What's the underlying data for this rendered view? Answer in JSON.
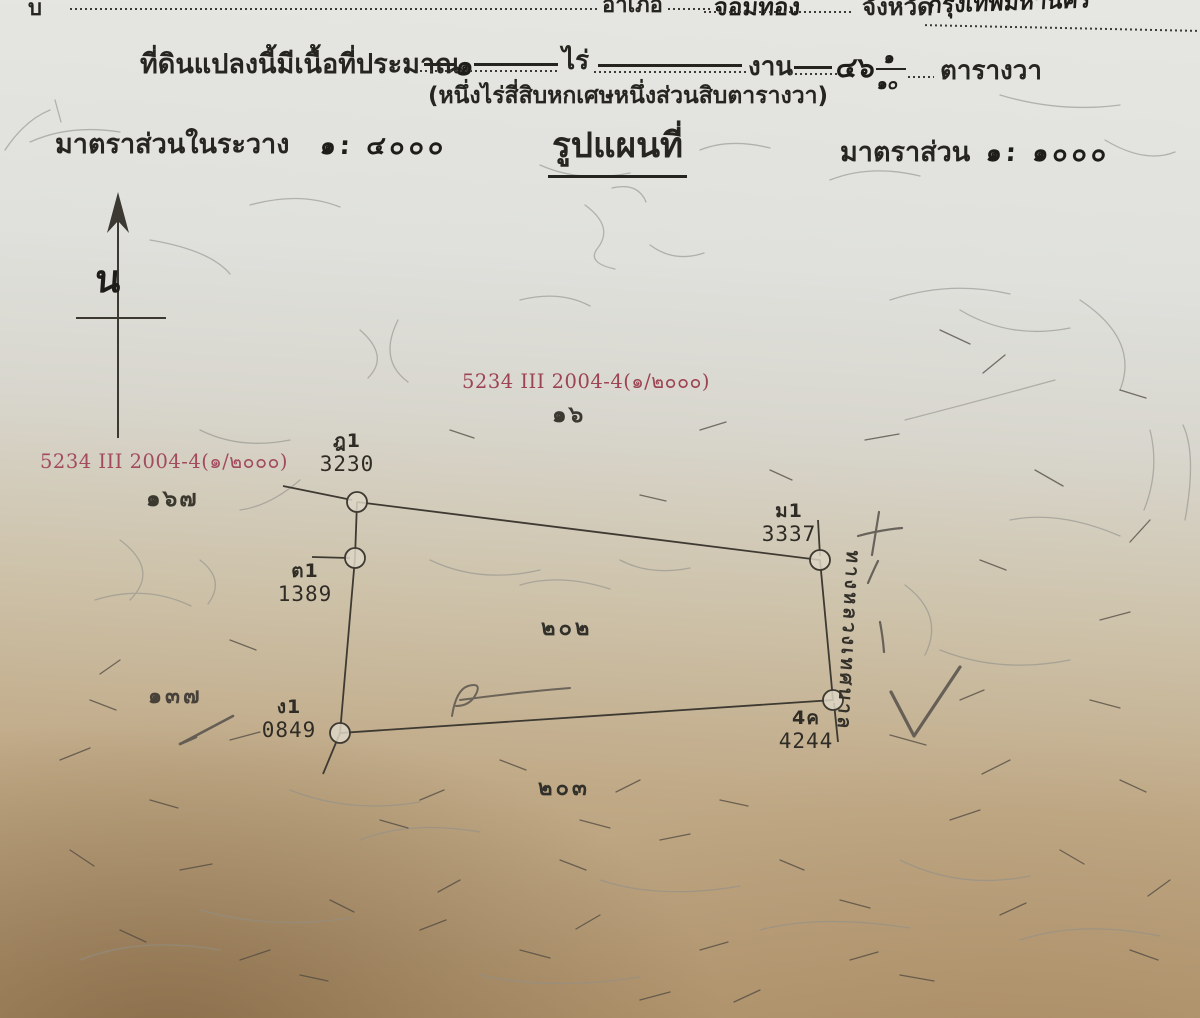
{
  "top_line": {
    "left_fragment": "บ",
    "district_label": "อำเภอ",
    "district_value": "จอมทอง",
    "province_label": "จังหวัด",
    "province_value": "กรุงเทพมหานคร"
  },
  "area_line": {
    "prefix": "ที่ดินแปลงนี้มีเนื้อที่ประมาณ",
    "rai_value": "๑",
    "rai_label": "ไร่",
    "ngan_label": "งาน",
    "wa_whole": "๔๖",
    "wa_frac_num": "๑",
    "wa_frac_den": "๑๐",
    "wa_label": "ตารางวา",
    "spelled_out": "(หนึ่งไร่สี่สิบหกเศษหนึ่งส่วนสิบตารางวา)"
  },
  "scale_line": {
    "sheet_scale_label": "มาตราส่วนในระวาง",
    "sheet_scale_value": "๑: ๔๐๐๐",
    "map_title": "รูปแผนที่",
    "map_scale_label": "มาตราส่วน",
    "map_scale_value": "๑: ๑๐๐๐"
  },
  "north_label": "น",
  "sheet_refs": {
    "left": {
      "code": "5234 III 2004-4(๑/๒๐๐๐)",
      "note": "๑๖๗"
    },
    "center": {
      "code": "5234 III 2004-4(๑/๒๐๐๐)",
      "note": "๑๖"
    }
  },
  "parcel": {
    "corners": [
      {
        "id": "ฎ1",
        "number": "3230"
      },
      {
        "id": "ม1",
        "number": "3337"
      },
      {
        "id": "ต1",
        "number": "1389"
      },
      {
        "id": "ง1",
        "number": "0849"
      },
      {
        "id": "4ค",
        "number": "4244"
      }
    ],
    "plot_number": "๒๐๒",
    "south_plot_number": "๒๐๓",
    "west_plot_number": "๑๓๗",
    "road_label": "ทางหลวงเทศบาล"
  },
  "colors": {
    "red_ink": "#a34b5e",
    "black_ink": "#27251f",
    "pencil": "#8f8e86",
    "paper_top": "#e4e4e0",
    "paper_bottom": "#b1966f"
  }
}
